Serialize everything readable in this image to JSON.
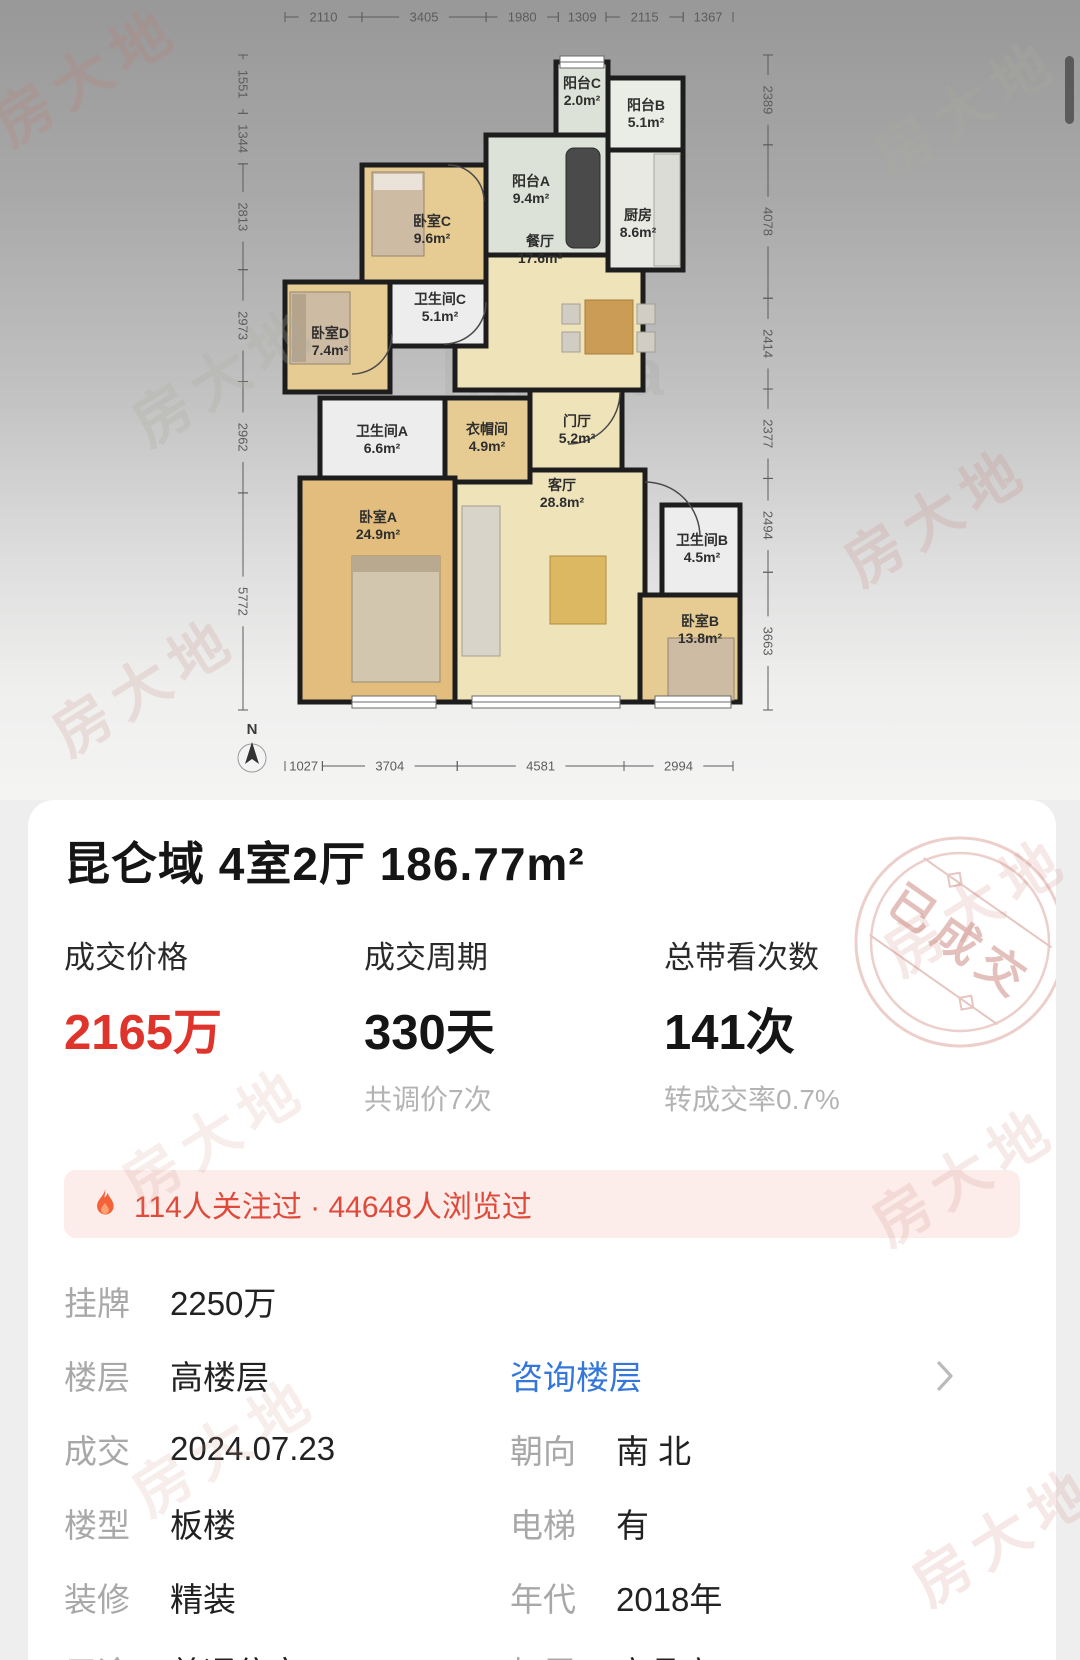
{
  "header": {
    "title": "昆仑域 4室2厅 186.77m²"
  },
  "stats": [
    {
      "label": "成交价格",
      "value": "2165万",
      "sub": ""
    },
    {
      "label": "成交周期",
      "value": "330天",
      "sub": "共调价7次"
    },
    {
      "label": "总带看次数",
      "value": "141次",
      "sub": "转成交率0.7%"
    }
  ],
  "notice": {
    "text": "114人关注过 · 44648人浏览过"
  },
  "details": {
    "rows": [
      {
        "label": "挂牌",
        "value": "2250万"
      },
      {
        "label": "楼层",
        "value": "高楼层",
        "link": "咨询楼层",
        "chevron": true
      },
      {
        "label": "成交",
        "value": "2024.07.23",
        "label2": "朝向",
        "value2": "南 北"
      },
      {
        "label": "楼型",
        "value": "板楼",
        "label2": "电梯",
        "value2": "有"
      },
      {
        "label": "装修",
        "value": "精装",
        "label2": "年代",
        "value2": "2018年"
      },
      {
        "label": "用途",
        "value": "普通住宅",
        "label2": "权属",
        "value2": "商品房"
      }
    ]
  },
  "stamp": {
    "text": "已成交"
  },
  "watermark": {
    "text": "房大地"
  },
  "floor_plan": {
    "north_label": "N",
    "top_dims": [
      "2110",
      "3405",
      "1980",
      "1309",
      "2115",
      "1367"
    ],
    "bottom_dims": [
      "1027",
      "3704",
      "4581",
      "2994"
    ],
    "left_dims": [
      "1551",
      "1344",
      "2813",
      "2973",
      "2962",
      "5772"
    ],
    "right_dims": [
      "2389",
      "4078",
      "2414",
      "2377",
      "2494",
      "3663"
    ],
    "rooms": [
      {
        "name": "餐厅",
        "area": "17.6m²",
        "type": "living",
        "x": 455,
        "y": 228,
        "w": 188,
        "h": 162,
        "lx": 540,
        "ly": 246
      },
      {
        "name": "门厅",
        "area": "5.2m²",
        "type": "living",
        "x": 530,
        "y": 390,
        "w": 92,
        "h": 90,
        "lx": 577,
        "ly": 426
      },
      {
        "name": "客厅",
        "area": "28.8m²",
        "type": "living",
        "x": 455,
        "y": 470,
        "w": 190,
        "h": 232,
        "lx": 562,
        "ly": 490
      },
      {
        "name": "阳台C",
        "area": "2.0m²",
        "type": "balcony",
        "x": 556,
        "y": 62,
        "w": 52,
        "h": 73,
        "lx": 582,
        "ly": 88
      },
      {
        "name": "阳台B",
        "area": "5.1m²",
        "type": "balcony2",
        "x": 608,
        "y": 78,
        "w": 75,
        "h": 72,
        "lx": 646,
        "ly": 110
      },
      {
        "name": "阳台A",
        "area": "9.4m²",
        "type": "balcony",
        "x": 486,
        "y": 135,
        "w": 122,
        "h": 120,
        "lx": 531,
        "ly": 186
      },
      {
        "name": "厨房",
        "area": "8.6m²",
        "type": "kitchen",
        "x": 608,
        "y": 150,
        "w": 75,
        "h": 120,
        "lx": 638,
        "ly": 220
      },
      {
        "name": "卧室C",
        "area": "9.6m²",
        "type": "bedroom",
        "x": 362,
        "y": 165,
        "w": 124,
        "h": 117,
        "lx": 432,
        "ly": 226
      },
      {
        "name": "卫生间C",
        "area": "5.1m²",
        "type": "bath",
        "x": 390,
        "y": 282,
        "w": 96,
        "h": 64,
        "lx": 440,
        "ly": 304
      },
      {
        "name": "卧室D",
        "area": "7.4m²",
        "type": "bedroom",
        "x": 285,
        "y": 282,
        "w": 105,
        "h": 110,
        "lx": 330,
        "ly": 338
      },
      {
        "name": "卫生间A",
        "area": "6.6m²",
        "type": "bath",
        "x": 320,
        "y": 398,
        "w": 125,
        "h": 94,
        "lx": 382,
        "ly": 436
      },
      {
        "name": "衣帽间",
        "area": "4.9m²",
        "type": "bedroom",
        "x": 445,
        "y": 398,
        "w": 85,
        "h": 84,
        "lx": 487,
        "ly": 434
      },
      {
        "name": "卧室A",
        "area": "24.9m²",
        "type": "bedroomA",
        "x": 300,
        "y": 478,
        "w": 155,
        "h": 224,
        "lx": 378,
        "ly": 522
      },
      {
        "name": "卫生间B",
        "area": "4.5m²",
        "type": "bath",
        "x": 662,
        "y": 505,
        "w": 78,
        "h": 90,
        "lx": 702,
        "ly": 545
      },
      {
        "name": "卧室B",
        "area": "13.8m²",
        "type": "bedroom",
        "x": 640,
        "y": 595,
        "w": 100,
        "h": 107,
        "lx": 700,
        "ly": 626
      }
    ]
  },
  "colors": {
    "price_red": "#df342b",
    "link_blue": "#3477db",
    "notice_red": "#e04a3b",
    "notice_bg": "#fcecea",
    "stamp_pink": "#dfb6b0"
  }
}
